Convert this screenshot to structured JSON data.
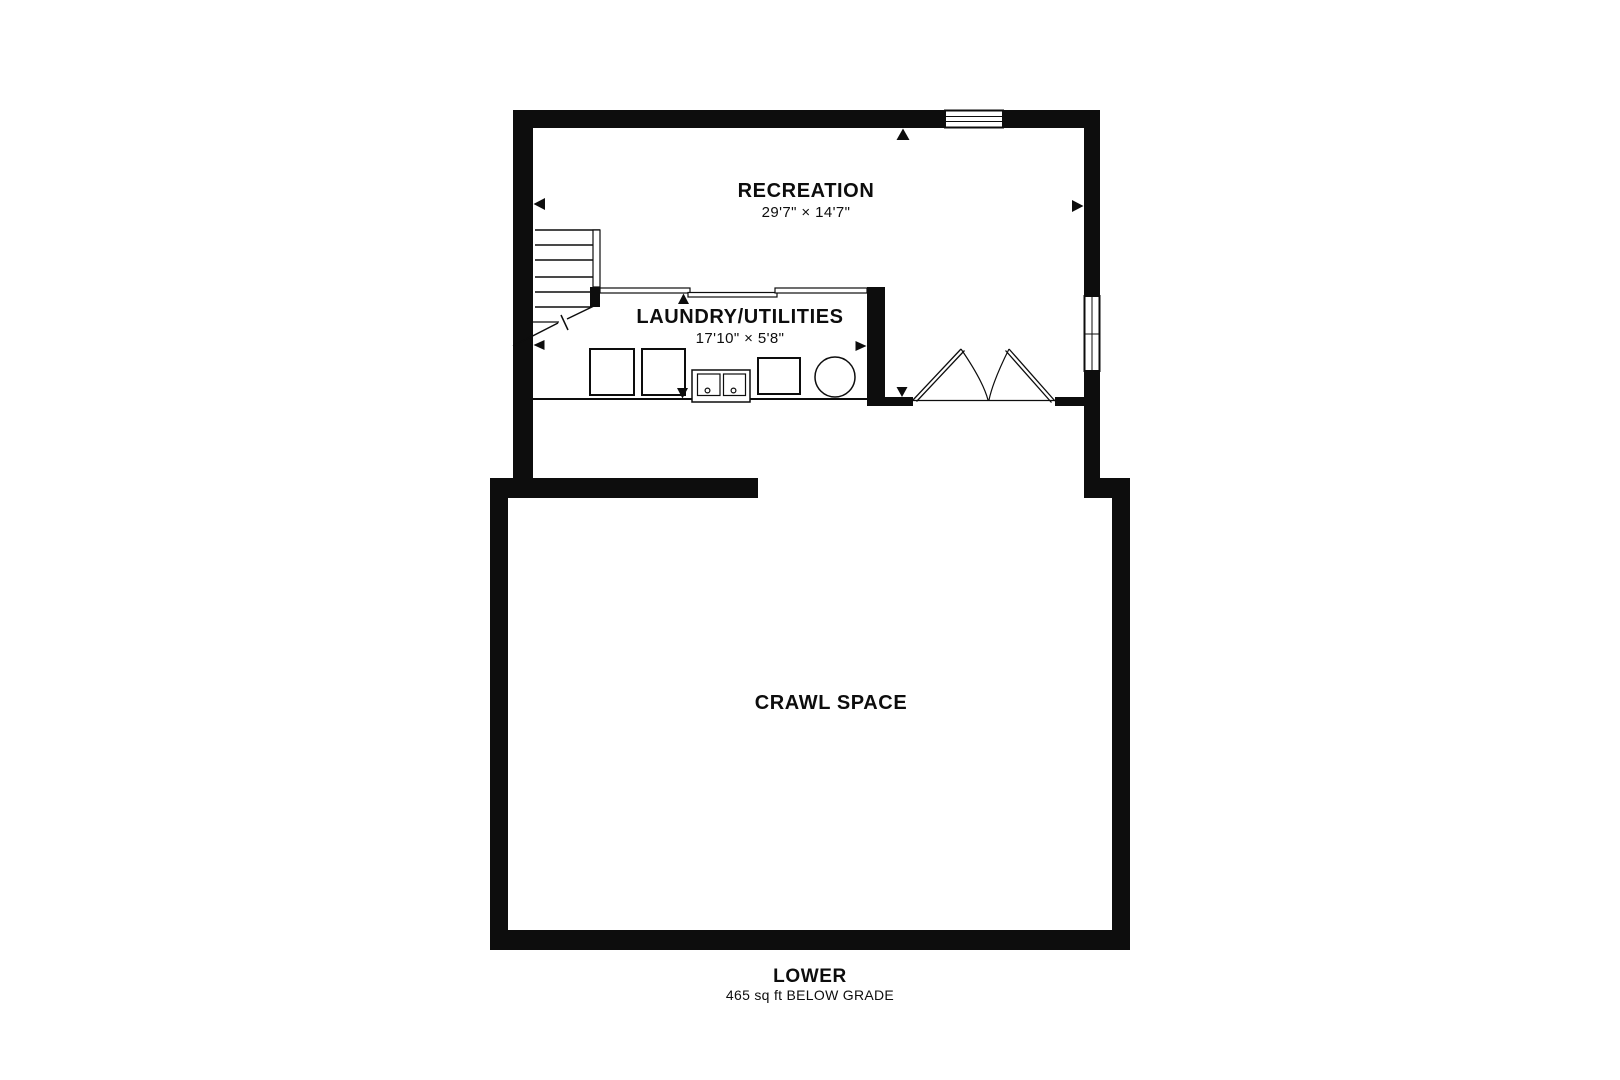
{
  "colors": {
    "ink": "#0d0d0d",
    "background": "#ffffff"
  },
  "rooms": {
    "recreation": {
      "label": "RECREATION",
      "dimensions": "29'7\" × 14'7\""
    },
    "laundry": {
      "label": "LAUNDRY/UTILITIES",
      "dimensions": "17'10\" × 5'8\""
    },
    "crawl_space": {
      "label": "CRAWL SPACE"
    }
  },
  "footer": {
    "floor_name": "LOWER",
    "area_note": "465 sq ft BELOW GRADE"
  },
  "symbols": {
    "door": "bifold-closet-door",
    "windows": [
      "top-wall-window",
      "right-wall-window"
    ],
    "stairs": "staircase-with-break-line",
    "appliances": [
      "washer",
      "dryer",
      "double-laundry-sink",
      "utility-unit",
      "water-heater-tank"
    ]
  }
}
